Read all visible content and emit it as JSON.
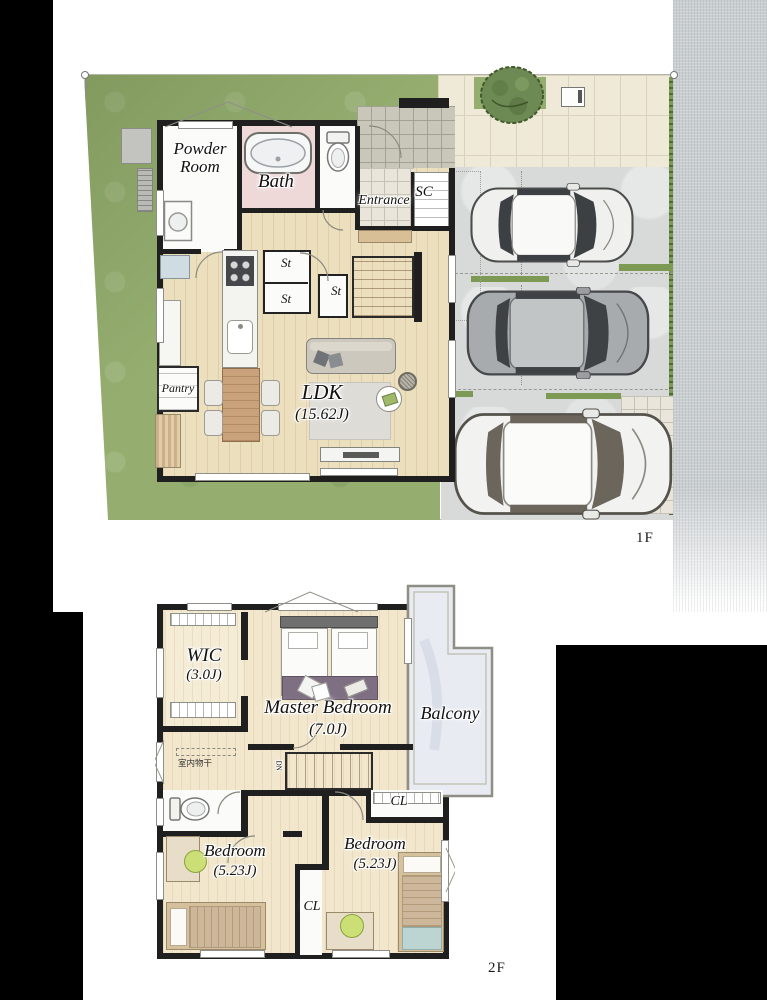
{
  "title": "Two-storey house floor plan with parking",
  "colors": {
    "wall": "#1f1f1f",
    "grass": "#95ae70",
    "hedge": "#7d9a55",
    "wood_floor": "#ecdfbe",
    "bath_pink": "#eed8d8",
    "driveway": "#d8dada",
    "road": "#c9ced0",
    "paver": "#efe9d8",
    "balcony_floor": "#e8ecf2",
    "rug_purple": "#7e6f82",
    "island_wood": "#c9a17b",
    "chair_green": "#ccdf77"
  },
  "f1": {
    "tag": "1F",
    "powder_line1": "Powder",
    "powder_line2": "Room",
    "bath": "Bath",
    "entrance": "Entrance",
    "sc": "SC",
    "st1": "St",
    "st2": "St",
    "st3": "St",
    "pantry": "Pantry",
    "ldk": "LDK",
    "ldk_size": "(15.62J)"
  },
  "f2": {
    "tag": "2F",
    "wic": "WIC",
    "wic_size": "(3.0J)",
    "master": "Master Bedroom",
    "master_size": "(7.0J)",
    "balcony": "Balcony",
    "drying": "室内物干",
    "dn": "DN",
    "cl1": "CL",
    "cl2": "CL",
    "bedroom1": "Bedroom",
    "bedroom1_size": "(5.23J)",
    "bedroom2": "Bedroom",
    "bedroom2_size": "(5.23J)"
  }
}
